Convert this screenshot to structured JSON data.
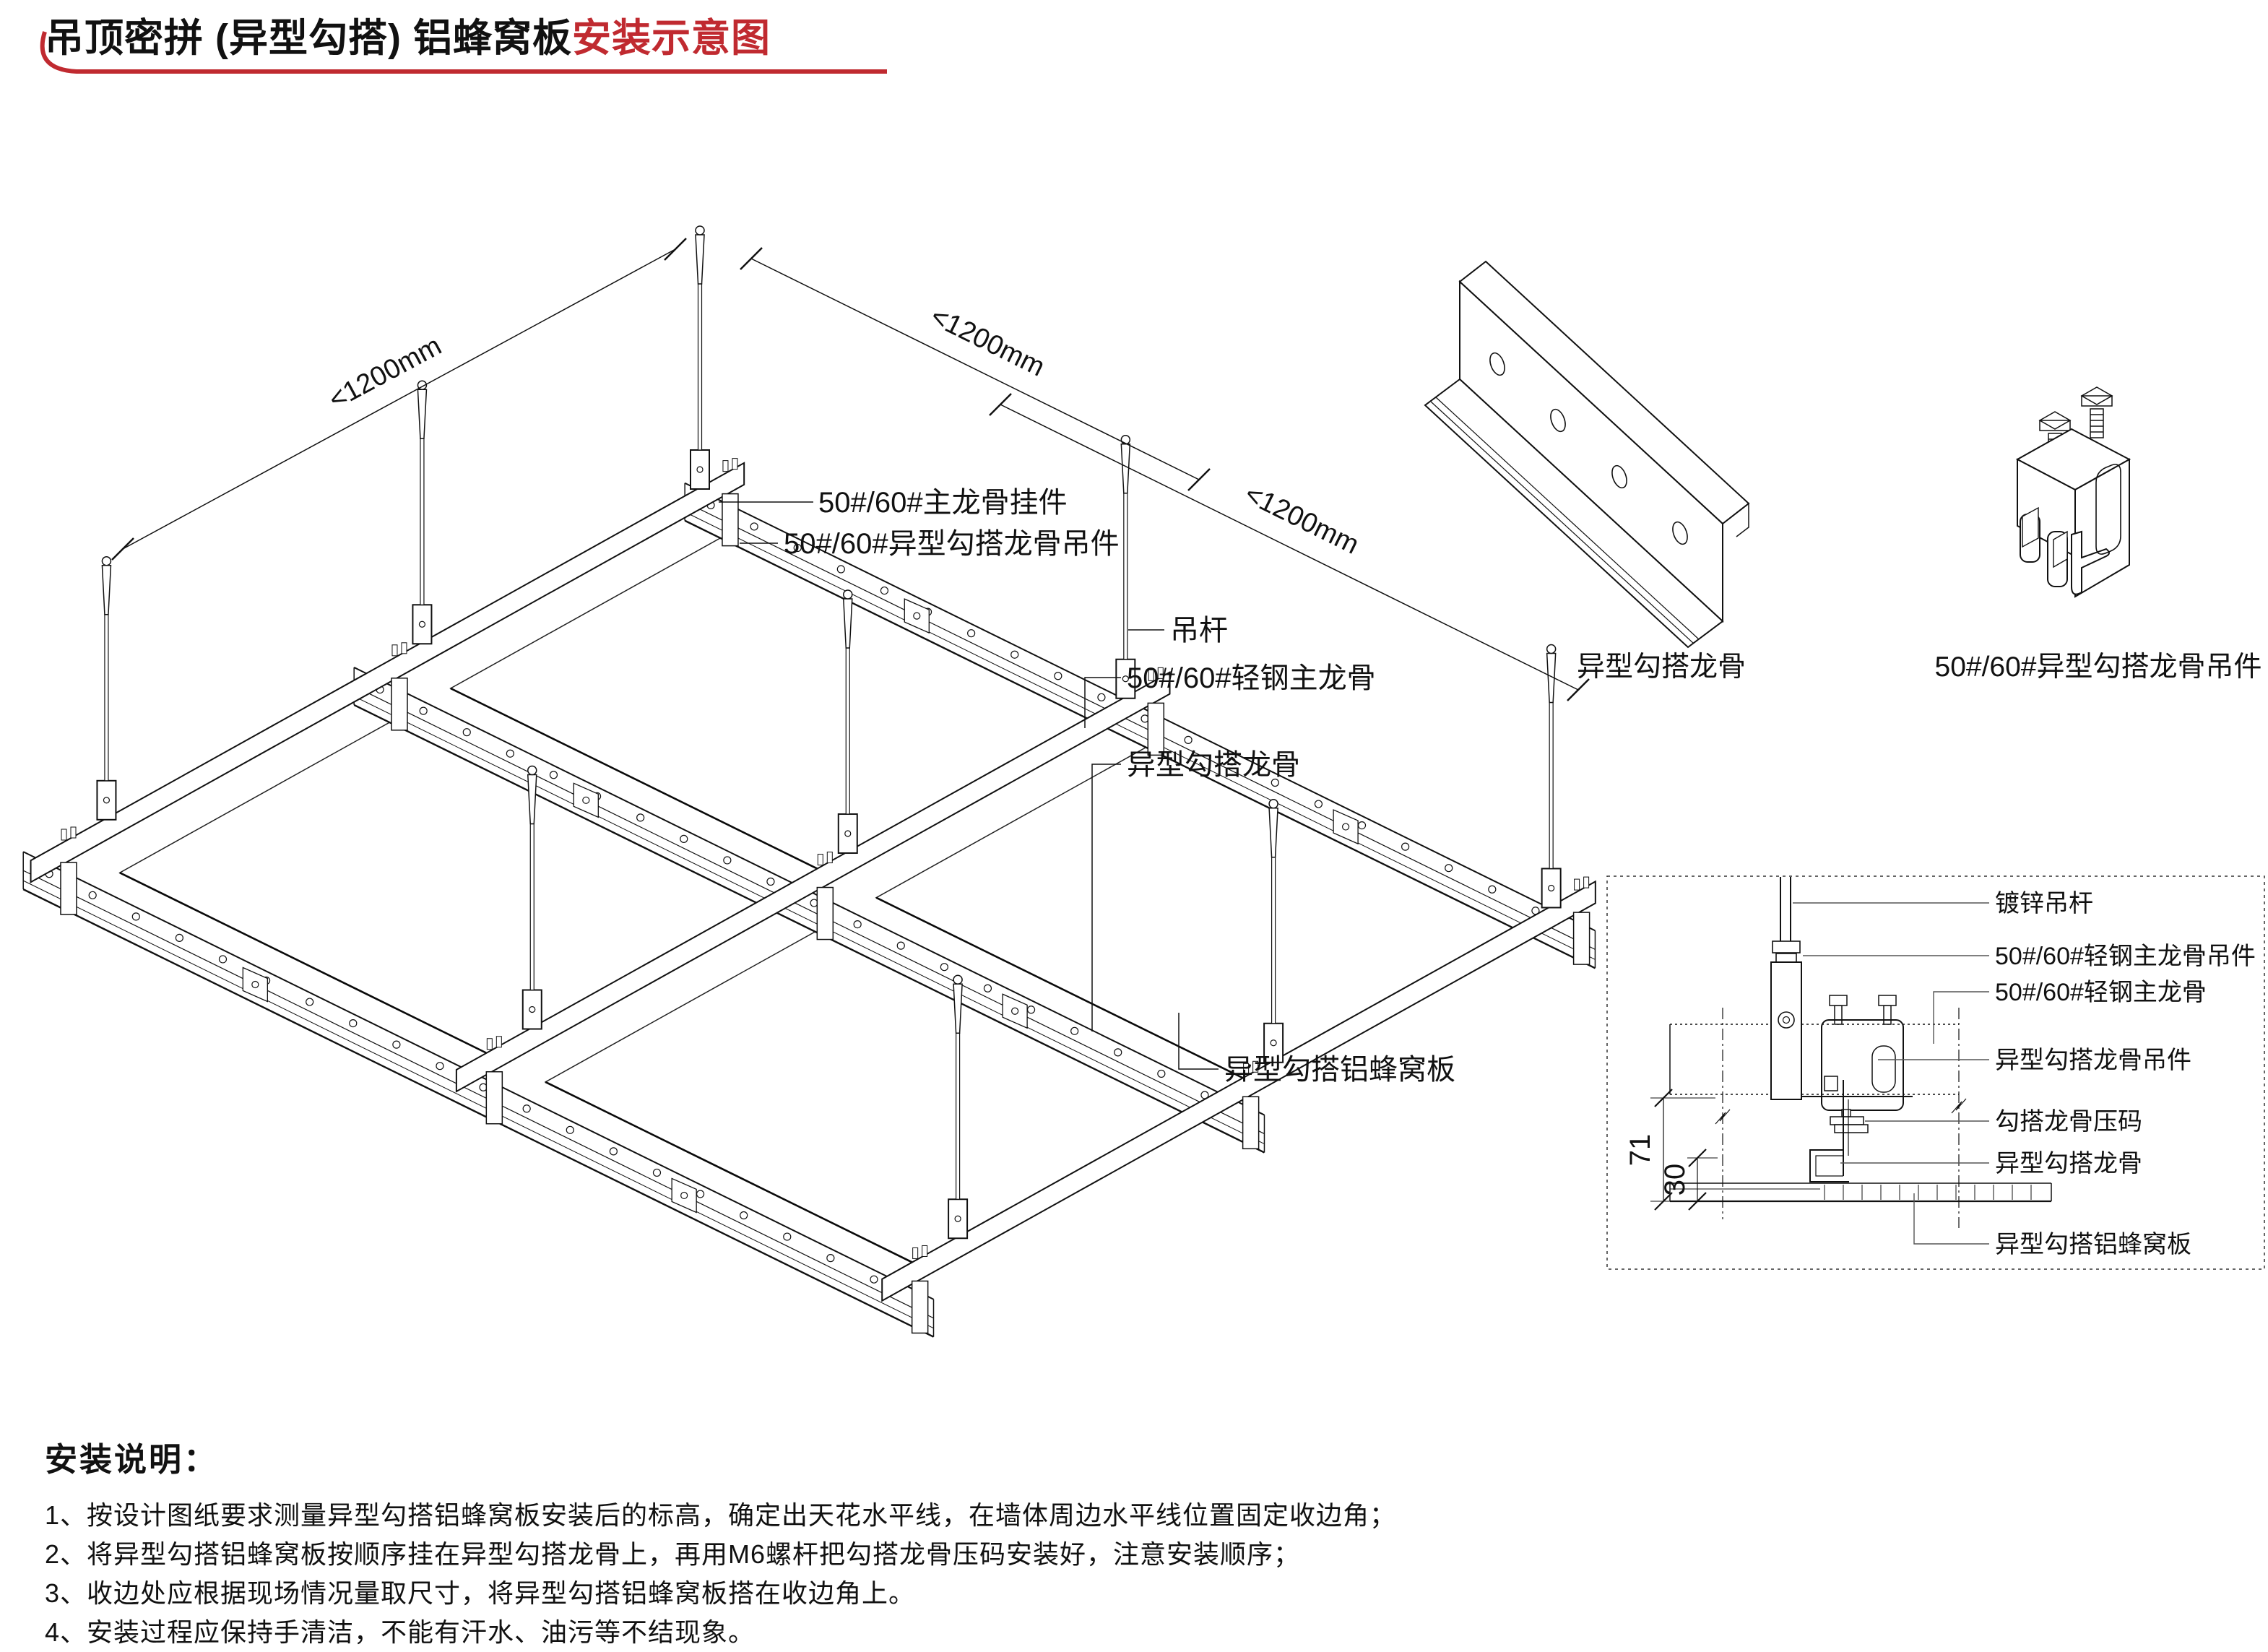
{
  "title": {
    "main": "吊顶密拼 (异型勾搭) 铝蜂窝板",
    "highlight": "安装示意图"
  },
  "main_diagram": {
    "dims": {
      "left": "<1200mm",
      "top": "<1200mm",
      "right": "<1200mm"
    },
    "labels": {
      "main_keel_hanger": "50#/60#主龙骨挂件",
      "hook_keel_clip": "50#/60#异型勾搭龙骨吊件",
      "hanger_rod": "吊杆",
      "light_steel_main_keel": "50#/60#轻钢主龙骨",
      "hook_keel": "异型勾搭龙骨",
      "honeycomb_panel": "异型勾搭铝蜂窝板"
    }
  },
  "components": {
    "hook_keel_caption": "异型勾搭龙骨",
    "clip_caption": "50#/60#异型勾搭龙骨吊件"
  },
  "detail_section": {
    "labels": {
      "galvanized_rod": "镀锌吊杆",
      "main_keel_hanger": "50#/60#轻钢主龙骨吊件",
      "main_keel": "50#/60#轻钢主龙骨",
      "hook_keel_clip": "异型勾搭龙骨吊件",
      "keel_clamp": "勾搭龙骨压码",
      "hook_keel": "异型勾搭龙骨",
      "honeycomb_panel": "异型勾搭铝蜂窝板"
    },
    "dimensions": {
      "overall": "71",
      "keel_height": "30"
    }
  },
  "notes": {
    "heading": "安装说明：",
    "items": [
      "1、按设计图纸要求测量异型勾搭铝蜂窝板安装后的标高，确定出天花水平线，在墙体周边水平线位置固定收边角；",
      "2、将异型勾搭铝蜂窝板按顺序挂在异型勾搭龙骨上，再用M6螺杆把勾搭龙骨压码安装好，注意安装顺序；",
      "3、收边处应根据现场情况量取尺寸，将异型勾搭铝蜂窝板搭在收边角上。",
      "4、安装过程应保持手清洁，不能有汗水、油污等不结现象。"
    ]
  },
  "colors": {
    "accent_red": "#C02A30",
    "line": "#111111"
  }
}
